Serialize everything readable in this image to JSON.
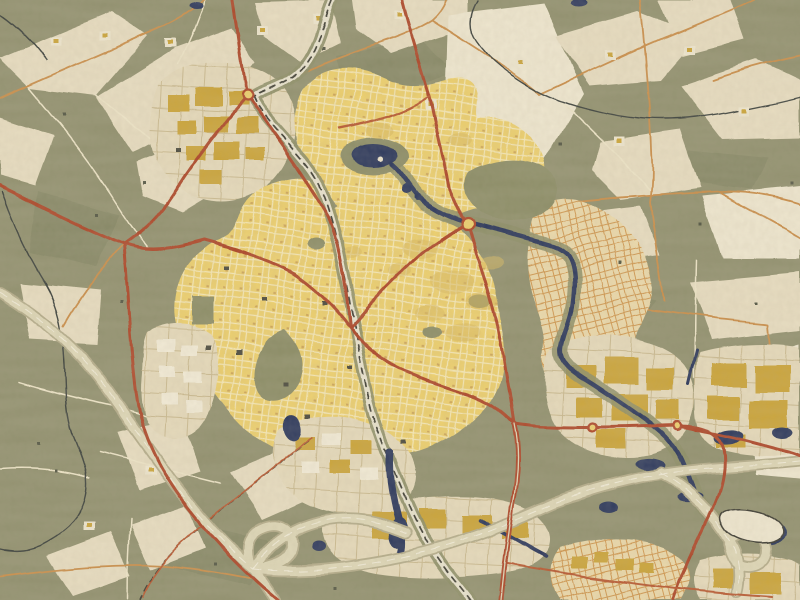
{
  "artwork": {
    "type": "stylized-map-art",
    "title": "Painted street map of a town in oil-paint (Van Gogh) style",
    "description": "Aerial map artwork: dense yellow town centre with red arterial roads, olive-green farmland with beige field patches, a dark blue river and ponds, a railway crossing the town and a motorway arc with interchanges in the south."
  },
  "palette": {
    "countryside": "#8b8b68",
    "forest": "#7c7f5d",
    "field_beige": "#e8ddc0",
    "field_cream": "#f0e8d0",
    "city_yellow": "#eecf66",
    "city_street": "#f7e9b4",
    "city_speck": "#c79a4e",
    "city_block_shadow": "#d9b755",
    "new_district": "#ecd9a8",
    "new_street": "#cf9347",
    "industrial_beige": "#e6daba",
    "industrial_street": "#c9b88c",
    "building_gold": "#c9a02e",
    "building_cream": "#f4edd8",
    "building_dark": "#3c3c30",
    "tree_dark": "#4a4d3a",
    "park_green": "#85875f",
    "water": "#1d2b52",
    "stream": "#2e3430",
    "road_red": "#a93a1d",
    "road_red_bright": "#b54f27",
    "road_orange": "#c8883f",
    "road_cream": "#efe6c8",
    "rail_band": "#e9e4cf",
    "rail_tick": "#33332a",
    "motorway_fill": "#ded7b6",
    "motorway_edge": "#b1a986",
    "motorway_line": "#f4efdc",
    "landmark_outline": "#2f2f28",
    "grain_tint": "#6b5a3f"
  },
  "features": {
    "regions": [
      {
        "id": "town-core",
        "label": "Town centre of dense yellow streets"
      },
      {
        "id": "north-residential",
        "label": "Northern residential neighbourhood"
      },
      {
        "id": "east-new-district",
        "label": "Eastern new-built district with curved streets"
      },
      {
        "id": "nw-business-park",
        "label": "North-west business park"
      },
      {
        "id": "se-industrial",
        "label": "South-east industrial estates"
      },
      {
        "id": "countryside",
        "label": "Olive farmland with beige field patches"
      }
    ],
    "water": [
      {
        "id": "town-pond",
        "label": "Large pond with island"
      },
      {
        "id": "river",
        "label": "River winding east then south"
      },
      {
        "id": "industrial-ponds",
        "label": "Ponds along the motorway"
      },
      {
        "id": "west-stream",
        "label": "Meandering stream west of town"
      },
      {
        "id": "northeast-stream",
        "label": "Meandering stream north-east of town"
      }
    ],
    "transport": [
      {
        "id": "railway",
        "label": "Railway line crossing town from north-west to south"
      },
      {
        "id": "motorway",
        "label": "Motorway arc with cloverleaf interchange"
      },
      {
        "id": "red-arterials",
        "label": "Red arterial roads"
      },
      {
        "id": "orange-lanes",
        "label": "Orange country lanes"
      },
      {
        "id": "roundabouts",
        "label": "Roundabouts"
      }
    ]
  }
}
